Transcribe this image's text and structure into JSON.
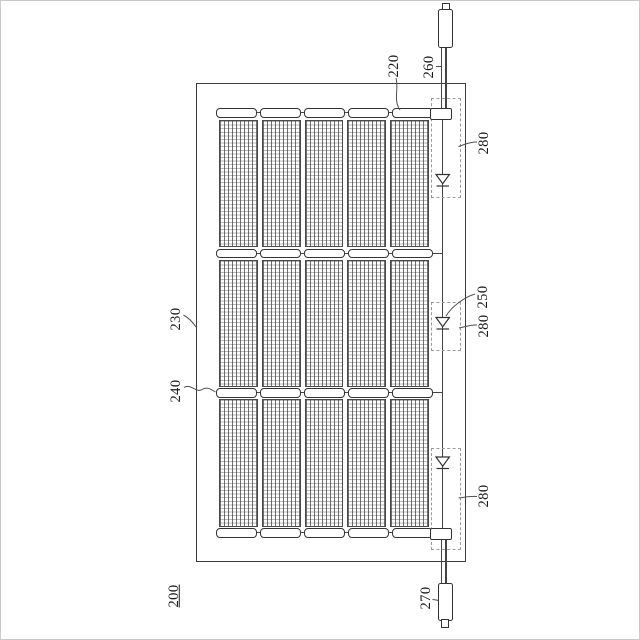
{
  "figure": {
    "figure_number": "200",
    "type": "patent-line-drawing",
    "colors": {
      "ink": "#3c3c3c",
      "grid": "#6a6a6a",
      "background": "#ffffff"
    },
    "structure": {
      "cell_groups": 3,
      "strips_per_group": 5,
      "busbars": 4,
      "bypass_diodes": 3,
      "junction_boxes": 3,
      "connectors": 2
    },
    "icons": {
      "bypass_diode": "diode-triangle-down",
      "connector": "plug-terminal"
    },
    "refs": {
      "cell_string": "220",
      "module_frame": "230",
      "busbar": "240",
      "bypass_diode": "250",
      "top_connector": "260",
      "bottom_connector": "270",
      "junction_top": "280",
      "junction_middle": "280",
      "junction_bottom": "280"
    }
  }
}
